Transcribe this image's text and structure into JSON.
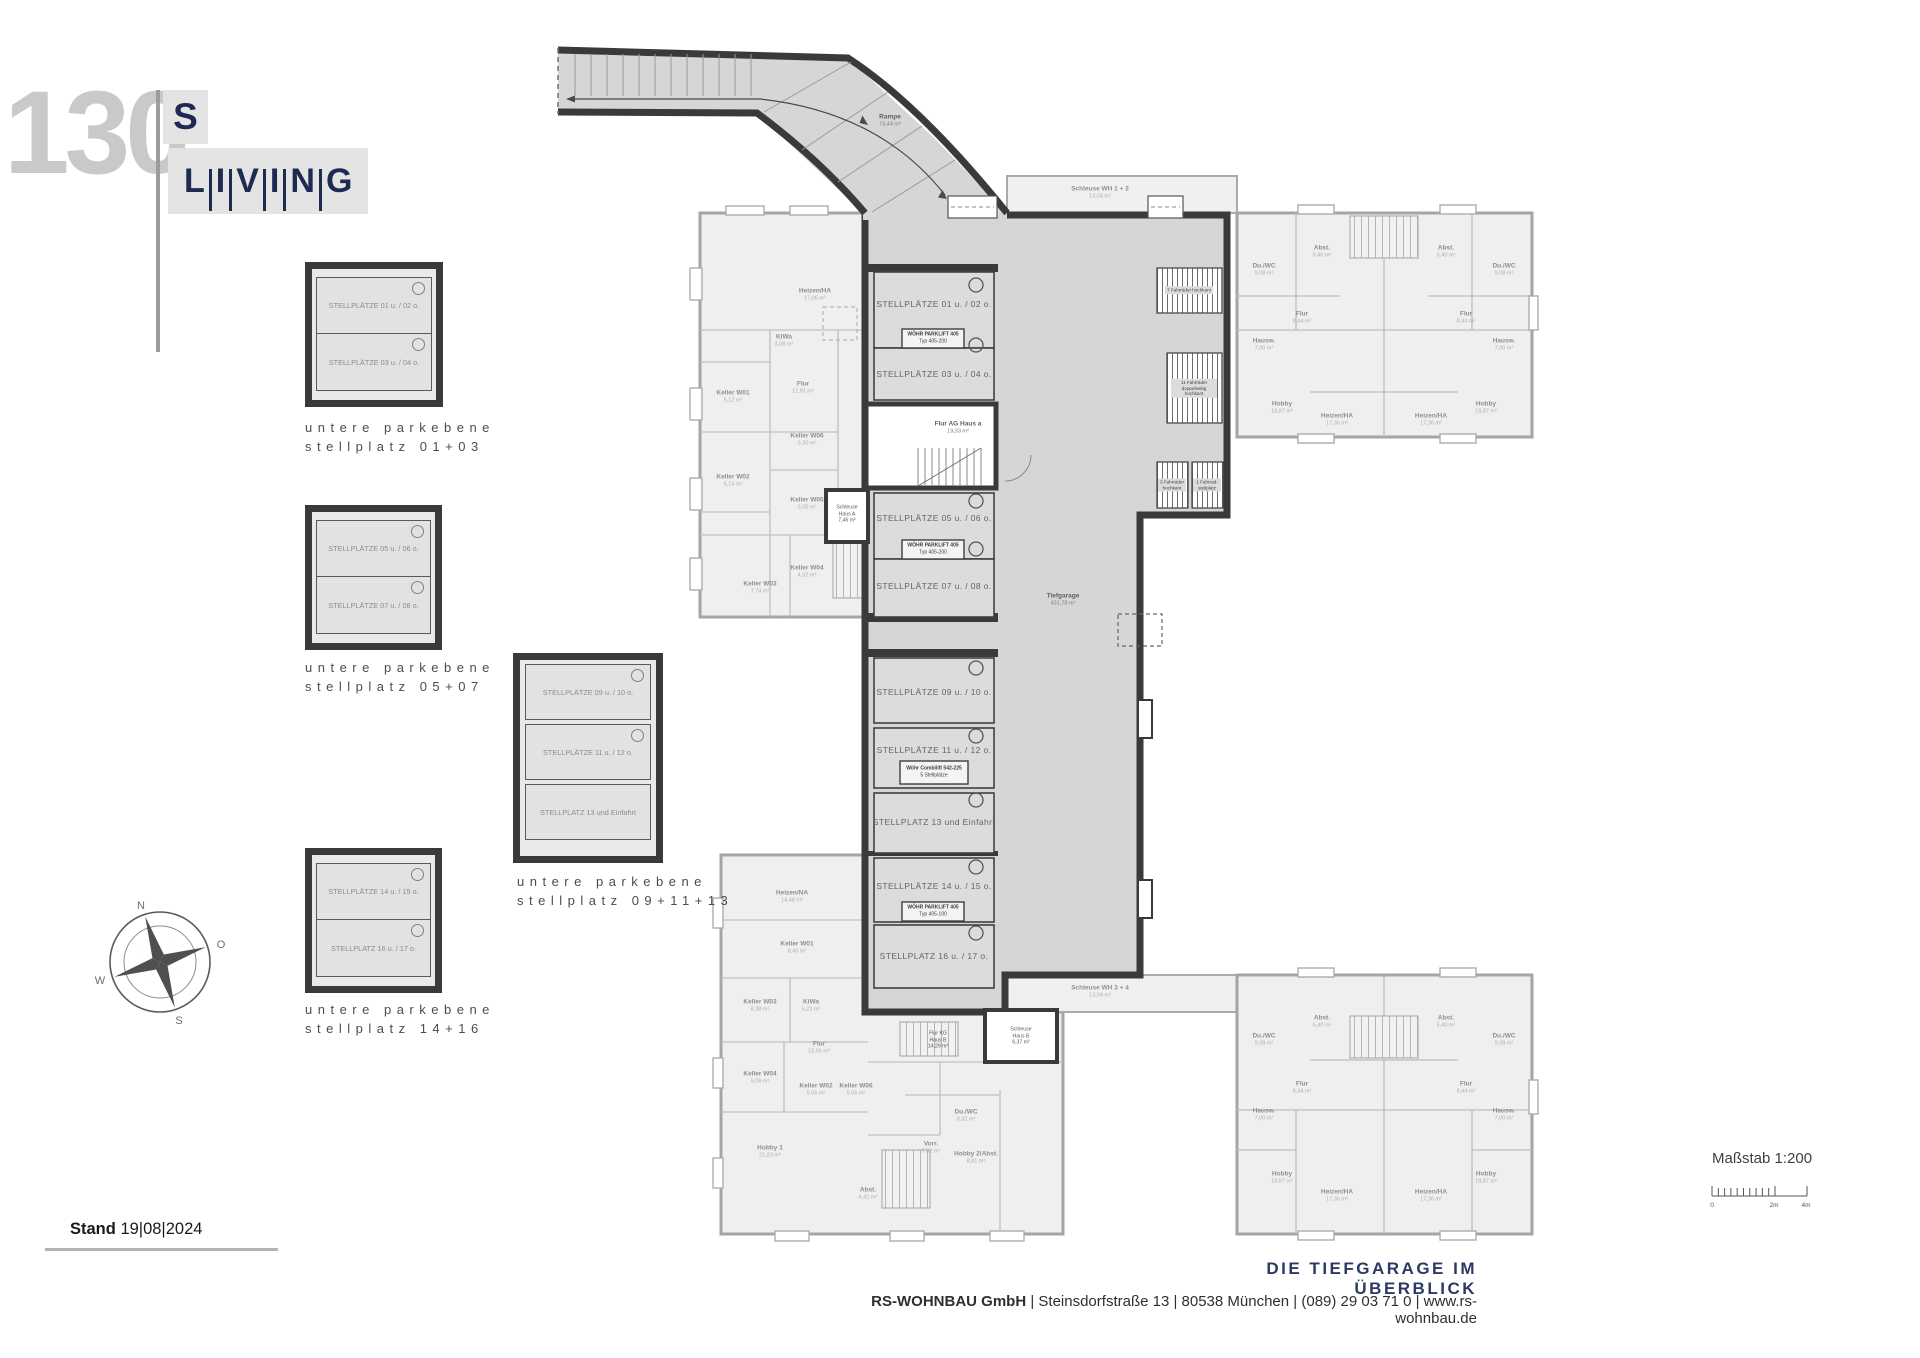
{
  "logo": {
    "number": "130",
    "top": "S",
    "letters": [
      "L",
      "I",
      "V",
      "I",
      "N",
      "G"
    ]
  },
  "insets": [
    {
      "cells": [
        {
          "label": "STELLPLÄTZE 01 u. / 02 o."
        },
        {
          "label": "STELLPLÄTZE 03 u. / 04 o."
        }
      ],
      "caption1": "untere parkebene",
      "caption2": "stellplatz 01+03"
    },
    {
      "cells": [
        {
          "label": "STELLPLÄTZE 05 u. / 06 o."
        },
        {
          "label": "STELLPLÄTZE 07 u. / 08 o."
        }
      ],
      "caption1": "untere parkebene",
      "caption2": "stellplatz 05+07"
    },
    {
      "cells": [
        {
          "label": "STELLPLÄTZE 09 u. / 10 o."
        },
        {
          "label": "STELLPLÄTZE 11 u. / 12 o."
        },
        {
          "label": "STELLPLATZ 13 und Einfahrt"
        }
      ],
      "caption1": "untere parkebene",
      "caption2": "stellplatz 09+11+13"
    },
    {
      "cells": [
        {
          "label": "STELLPLÄTZE 14 u. / 15 o."
        },
        {
          "label": "STELLPLATZ 16 u. / 17 o."
        }
      ],
      "caption1": "untere parkebene",
      "caption2": "stellplatz 14+16"
    }
  ],
  "compass": {
    "n": "N",
    "e": "O",
    "s": "S",
    "w": "W"
  },
  "stand": {
    "label": "Stand",
    "date": "19|08|2024"
  },
  "masstab": {
    "label": "Maßstab 1:200",
    "t0": "0",
    "t1": "2m",
    "t2": "4m"
  },
  "footer": {
    "title": "DIE TIEFGARAGE IM ÜBERBLICK",
    "company": "RS-WOHNBAU GmbH",
    "rest": " | Steinsdorfstraße 13 |  80538 München | (089) 29 03 71 0 | www.rs-wohnbau.de"
  },
  "plan": {
    "ramp": {
      "name": "Rampe",
      "area": "73,44 m²"
    },
    "garage": {
      "name": "Tiefgarage",
      "area": "431,78 m²"
    },
    "stalls": [
      "STELLPLÄTZE 01 u. / 02 o.",
      "STELLPLÄTZE 03 u. / 04 o.",
      "STELLPLÄTZE 05 u. / 06 o.",
      "STELLPLÄTZE 07 u. / 08 o.",
      "STELLPLÄTZE 09 u. / 10 o.",
      "STELLPLÄTZE 11 u. / 12 o.",
      "STELLPLATZ 13 und Einfahrt",
      "STELLPLÄTZE 14 u. / 15 o.",
      "STELLPLATZ 16 u. / 17 o."
    ],
    "lifts": [
      {
        "l1": "WÖHR PARKLIFT 405",
        "l2": "Typ 405-200"
      },
      {
        "l1": "WÖHR PARKLIFT 405",
        "l2": "Typ 405-200"
      },
      {
        "l1": "Wöhr Combilift 542-225",
        "l2": "5 Stellplätze"
      },
      {
        "l1": "WÖHR PARKLIFT 405",
        "l2": "Typ 405-100"
      }
    ],
    "bikes": [
      "7 Fahrräder hochkant",
      "11 Fahrräder doppelseitig hochkant",
      "3 Fahrräder hochkant",
      "1 Fahrrad-stellplatz"
    ],
    "flur_ag": {
      "name": "Flur AG Haus a",
      "area": "19,33 m²"
    },
    "schleuse_a": {
      "l1": "Schleuse",
      "l2": "Haus A",
      "area": "7,46 m²"
    },
    "schleuse_b": {
      "l1": "Schleuse",
      "l2": "Haus B",
      "area": "6,37 m²"
    },
    "flur_kg": {
      "l1": "Flur KG",
      "l2": "Haus B",
      "area": "14,29 m²"
    },
    "schleuse_wh12": {
      "name": "Schleuse WH 1 + 2",
      "area": "13,04 m²"
    },
    "schleuse_wh34": {
      "name": "Schleuse WH 3 + 4",
      "area": "13,04 m²"
    },
    "haus_a": {
      "rooms": [
        {
          "name": "Heizen/HA",
          "area": "17,06 m²"
        },
        {
          "name": "KiWa",
          "area": "4,08 m²"
        },
        {
          "name": "Keller W01",
          "area": "5,12 m²"
        },
        {
          "name": "Flur",
          "area": "12,91 m²"
        },
        {
          "name": "Keller W06",
          "area": "5,30 m²"
        },
        {
          "name": "Keller W02",
          "area": "5,14 m²"
        },
        {
          "name": "Keller W05",
          "area": "5,05 m²"
        },
        {
          "name": "Keller W03",
          "area": "7,74 m²"
        },
        {
          "name": "Keller W04",
          "area": "4,32 m²"
        }
      ]
    },
    "haus_b": {
      "rooms": [
        {
          "name": "Heizen/NA",
          "area": "14,48 m²"
        },
        {
          "name": "Keller W01",
          "area": "8,40 m²"
        },
        {
          "name": "Keller W03",
          "area": "8,38 m²"
        },
        {
          "name": "KiWa",
          "area": "5,22 m²"
        },
        {
          "name": "Flur",
          "area": "15,56 m²"
        },
        {
          "name": "Keller W04",
          "area": "5,06 m²"
        },
        {
          "name": "Keller W02",
          "area": "5,06 m²"
        },
        {
          "name": "Keller W06",
          "area": "5,06 m²"
        },
        {
          "name": "Hobby 1",
          "area": "21,23 m²"
        },
        {
          "name": "Abst.",
          "area": "4,41 m²"
        },
        {
          "name": "Vorr.",
          "area": "7,32 m²"
        },
        {
          "name": "Du./WC",
          "area": "8,32 m²"
        },
        {
          "name": "Hobby 2/Abst.",
          "area": "8,81 m²"
        }
      ]
    },
    "wh_unit": {
      "rooms": [
        {
          "name": "Du./WC",
          "area": "9,08 m²"
        },
        {
          "name": "Abst.",
          "area": "5,40 m²"
        },
        {
          "name": "Flur",
          "area": "8,44 m²"
        },
        {
          "name": "Hausw.",
          "area": "7,00 m²"
        },
        {
          "name": "Hobby",
          "area": "18,87 m²"
        },
        {
          "name": "Heizen/HA",
          "area": "17,36 m²"
        }
      ]
    }
  }
}
